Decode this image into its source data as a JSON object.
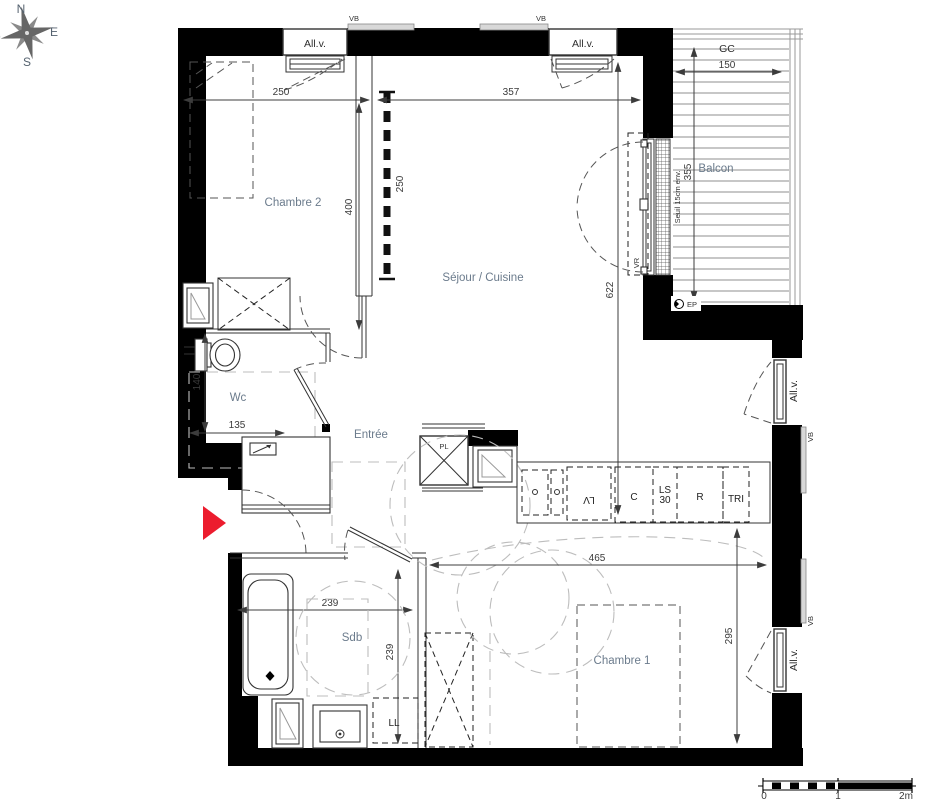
{
  "compass": {
    "n": "N",
    "e": "E",
    "s": "S",
    "o": "O"
  },
  "rooms": {
    "chambre2": "Chambre 2",
    "sejour": "Séjour / Cuisine",
    "balcon": "Balcon",
    "wc": "Wc",
    "entree": "Entrée",
    "sdb": "Sdb",
    "chambre1": "Chambre 1"
  },
  "dims": {
    "chambre2_w": "250",
    "chambre2_h": "400",
    "cloison": "250",
    "sejour_w": "357",
    "sejour_h": "622",
    "balcon_d": "150",
    "balcon_h": "355",
    "wc_h": "140",
    "wc_w": "135",
    "sdb_w": "239",
    "sdb_h": "239",
    "chambre1_w": "465",
    "chambre1_h": "295"
  },
  "labels": {
    "allv": "All.v.",
    "vb": "VB",
    "gc": "GC",
    "vr": "VR",
    "seuil": "Seuil 15cm env.",
    "ep": "EP",
    "pl": "PL",
    "lv": "LV",
    "ls": "LS",
    "ls30": "30",
    "c": "C",
    "r": "R",
    "tri": "TRI",
    "ll": "LL"
  },
  "scalebar": {
    "t0": "0",
    "t1": "1",
    "t2": "2m"
  },
  "colors": {
    "wall": "#000000",
    "room_label": "#6b7b8c",
    "dim_text": "#3a3a3a",
    "red_arrow": "#ec1c2e",
    "dashed_gray": "#bdbdbd",
    "shutter_gray": "#d8d8d8"
  }
}
